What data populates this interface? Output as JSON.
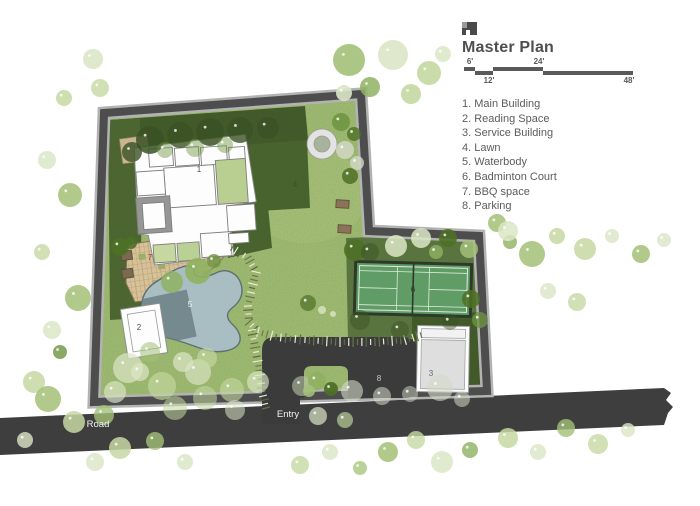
{
  "header": {
    "title": "Master Plan",
    "logo": "architect-logo"
  },
  "scale_bar": {
    "labels": [
      "6'",
      "12'",
      "24'",
      "48'"
    ]
  },
  "legend": {
    "items": [
      "1. Main Building",
      "2. Reading Space",
      "3. Service Building",
      "4. Lawn",
      "5. Waterbody",
      "6. Badminton Court",
      "7. BBQ space",
      "8. Parking"
    ]
  },
  "plan": {
    "area_labels": [
      {
        "id": "main-building",
        "label": "1"
      },
      {
        "id": "reading-space",
        "label": "2"
      },
      {
        "id": "service-building",
        "label": "3"
      },
      {
        "id": "lawn",
        "label": "4"
      },
      {
        "id": "waterbody",
        "label": "5"
      },
      {
        "id": "badminton-court",
        "label": "6"
      },
      {
        "id": "bbq-space",
        "label": "7"
      },
      {
        "id": "parking",
        "label": "8"
      }
    ],
    "road_label": "Road",
    "entry_label": "Entry"
  },
  "palette": {
    "road": "#3e3e3e",
    "boundary": "#4d4d4d",
    "lawn": "#a6c178",
    "dark_planting": "#3f5528",
    "pool": "#a9bec2",
    "court": "#5f9c66",
    "paving": "#d6c198"
  }
}
